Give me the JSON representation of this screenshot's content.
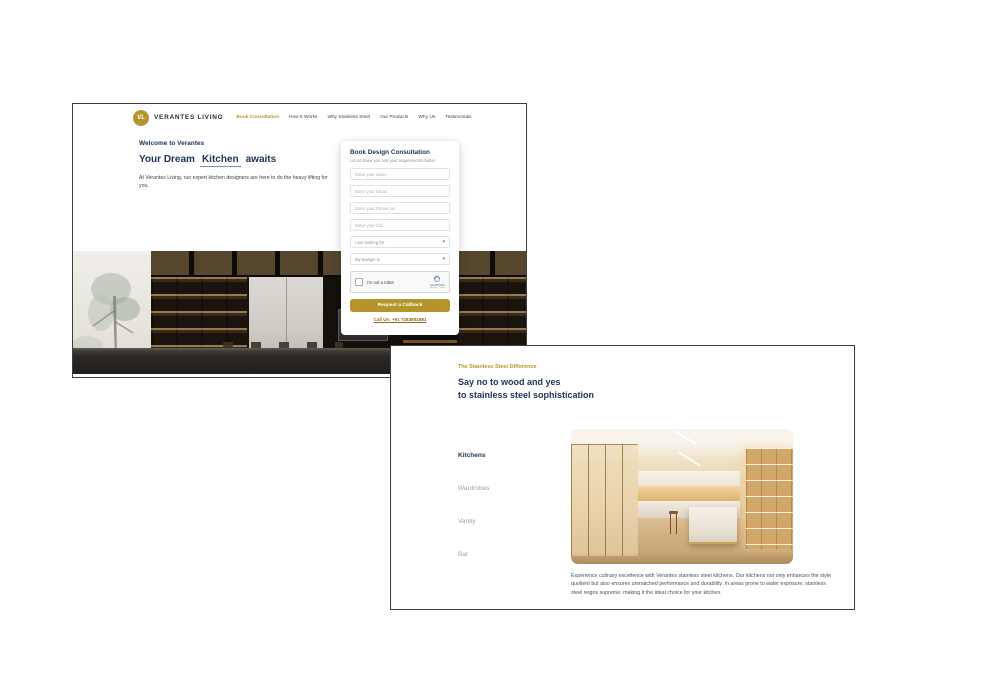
{
  "colors": {
    "gold": "#b5952b",
    "navy": "#1d3354",
    "window_border": "#3e3e3e",
    "button": "#b5952b"
  },
  "window1": {
    "brand": {
      "monogram": "VL",
      "name": "VERANTES LIVING"
    },
    "nav": {
      "book_consultation": "Book Consultation",
      "how_it_works": "How It Works",
      "why_stainless_steel": "Why Stainless Steel",
      "our_products": "Our Products",
      "why_us": "Why Us",
      "testimonials": "Testimonials"
    },
    "hero": {
      "eyebrow": "Welcome to Verantes",
      "title_prefix": "Your Dream",
      "title_word": "Kitchen",
      "title_suffix": "awaits",
      "description": "At Verantes Living, our expert kitchen designers are here to do the heavy lifting for you."
    },
    "form": {
      "title": "Book Design Consultation",
      "subtitle": "Let us know you and your requirements better",
      "placeholders": {
        "name": "Enter your name",
        "email": "Enter your Email",
        "phone": "Enter your Phone No",
        "city": "Enter your City"
      },
      "selects": {
        "looking_for": "I am looking for",
        "budget": "My Budget is"
      },
      "recaptcha": {
        "label": "I'm not a robot",
        "brand": "reCAPTCHA",
        "links": "Privacy - Terms"
      },
      "submit_label": "Request a Callback",
      "call_us": "Call Us: +91 7283801881"
    }
  },
  "window2": {
    "eyebrow": "The Stainless Steel Difference",
    "heading": {
      "line1": "Say no to wood and yes",
      "line2": "to stainless steel sophistication"
    },
    "menu": {
      "kitchens": "Kitchens",
      "wardrobes": "Wardrobes",
      "vanity": "Vanity",
      "bar": "Bar"
    },
    "description": "Experience culinary excellence with Verantes stainless steel kitchens. Our kitchens not only enhances the style quotient but also ensures unmatched performance and durability. In areas prone to water exposure, stainless steel reigns supreme, making it the ideal choice for your kitchen."
  }
}
